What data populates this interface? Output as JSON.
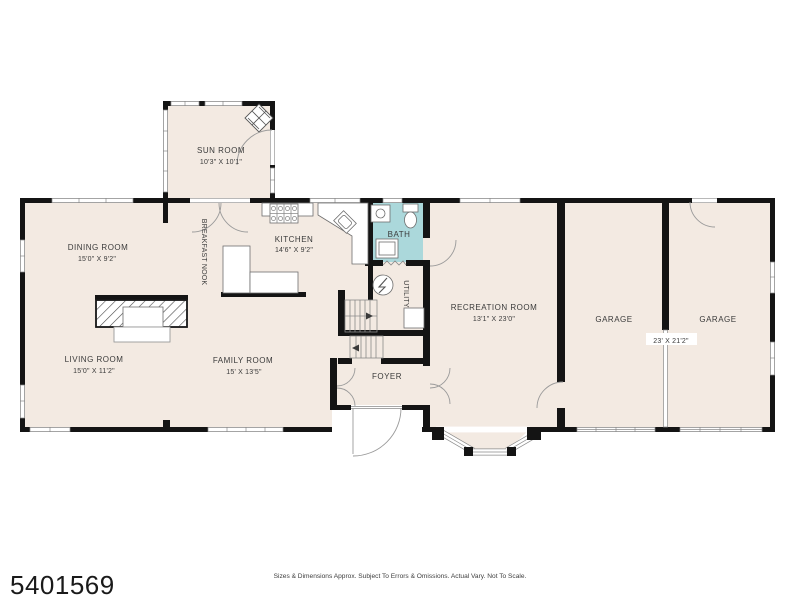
{
  "footer": {
    "listing_id": "5401569",
    "disclaimer": "Sizes & Dimensions Approx. Subject To Errors & Omissions. Actual Vary. Not To Scale."
  },
  "colors": {
    "floor": "#f3eae2",
    "bath_floor": "#abd8db",
    "wall": "#141414",
    "text": "#3a3a3a"
  },
  "rooms": {
    "sun_room": {
      "name": "SUN ROOM",
      "dims": "10'3\" X 10'1\""
    },
    "dining_room": {
      "name": "DINING ROOM",
      "dims": "15'0\" X 9'2\""
    },
    "breakfast_nook": {
      "name": "BREAKFAST NOOK"
    },
    "kitchen": {
      "name": "KITCHEN",
      "dims": "14'6\" X 9'2\""
    },
    "bath": {
      "name": "BATH"
    },
    "utility": {
      "name": "UTILITY"
    },
    "recreation_room": {
      "name": "RECREATION ROOM",
      "dims": "13'1\" X 23'0\""
    },
    "garage_left": {
      "name": "GARAGE"
    },
    "garage_right": {
      "name": "GARAGE"
    },
    "garages": {
      "dims": "23' X 21'2\""
    },
    "living_room": {
      "name": "LIVING ROOM",
      "dims": "15'0\" X 11'2\""
    },
    "family_room": {
      "name": "FAMILY ROOM",
      "dims": "15' X 13'5\""
    },
    "foyer": {
      "name": "FOYER"
    }
  }
}
